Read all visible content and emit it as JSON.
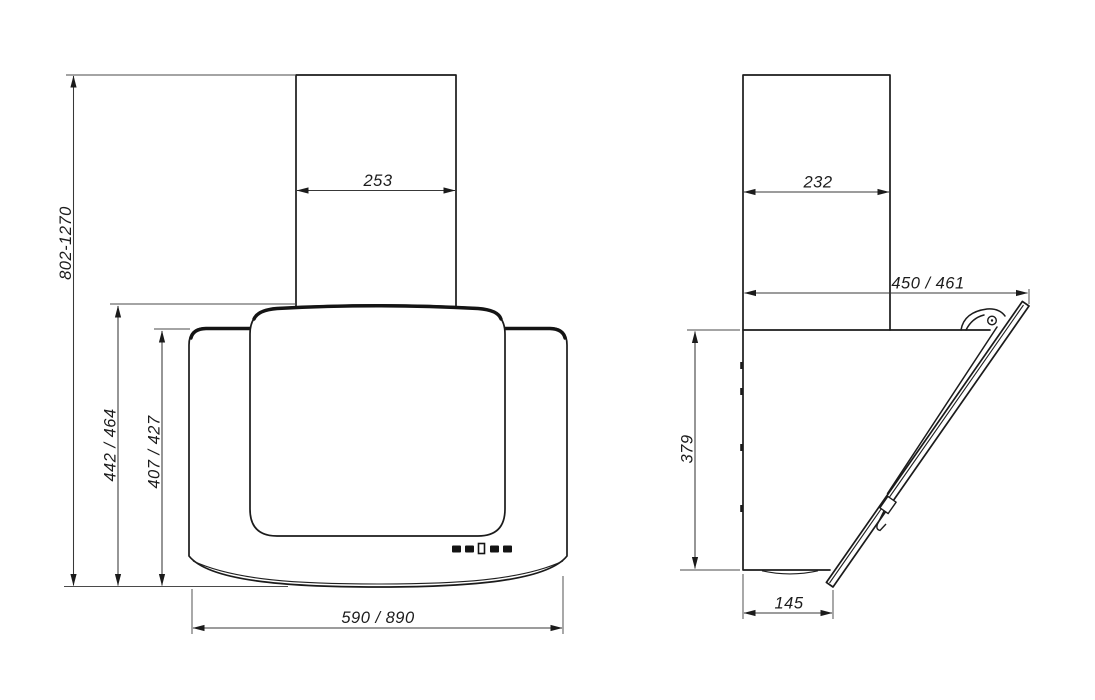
{
  "colors": {
    "background": "#ffffff",
    "outline": "#1b1b1b",
    "dimension_line": "#383838",
    "dimension_text": "#1c1c1c"
  },
  "front_view": {
    "dims": {
      "total_height": "802-1270",
      "chimney_width": "253",
      "glass_height": "442 / 464",
      "body_height": "407 / 427",
      "body_width": "590 / 890"
    },
    "controls": {
      "button_count": 5
    }
  },
  "side_view": {
    "dims": {
      "chimney_depth": "232",
      "total_depth": "450 / 461",
      "body_height": "379",
      "bottom_depth": "145"
    }
  }
}
